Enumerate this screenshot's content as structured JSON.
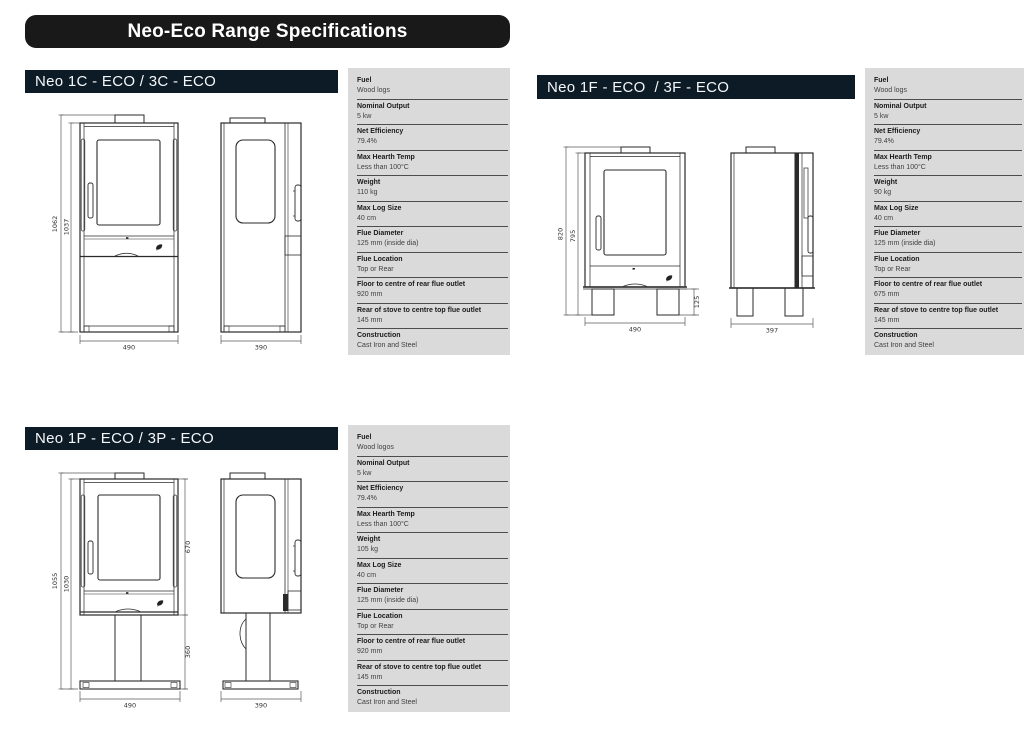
{
  "page": {
    "title": "Neo-Eco Range Specifications"
  },
  "colors": {
    "title_bar": "#191919",
    "section_header": "#0d1b27",
    "table_background": "#dadada",
    "drawing_line": "#2a2a2a"
  },
  "sections": [
    {
      "id": "neo-1c",
      "title": "Neo 1C - ECO / 3C - ECO",
      "dims": {
        "overall_height": "1062",
        "body_height": "1037",
        "front_width": "490",
        "side_depth": "390"
      },
      "specs": [
        {
          "label": "Fuel",
          "value": "Wood logs"
        },
        {
          "label": "Nominal Output",
          "value": "5 kw"
        },
        {
          "label": "Net Efficiency",
          "value": "79.4%"
        },
        {
          "label": "Max Hearth Temp",
          "value": "Less than 100°C"
        },
        {
          "label": "Weight",
          "value": "110 kg"
        },
        {
          "label": "Max Log Size",
          "value": "40 cm"
        },
        {
          "label": "Flue Diameter",
          "value": "125 mm (inside dia)"
        },
        {
          "label": "Flue Location",
          "value": "Top or Rear"
        },
        {
          "label": "Floor to centre of rear flue outlet",
          "value": "920 mm"
        },
        {
          "label": "Rear of stove to centre top flue outlet",
          "value": "145 mm"
        },
        {
          "label": "Construction",
          "value": "Cast Iron and Steel"
        }
      ]
    },
    {
      "id": "neo-1f",
      "title": "Neo 1F - ECO  / 3F - ECO",
      "dims": {
        "overall_height": "820",
        "body_height": "795",
        "front_width": "490",
        "side_depth": "397",
        "leg_height": "125"
      },
      "specs": [
        {
          "label": "Fuel",
          "value": "Wood logs"
        },
        {
          "label": "Nominal Output",
          "value": "5 kw"
        },
        {
          "label": "Net Efficiency",
          "value": "79.4%"
        },
        {
          "label": "Max Hearth Temp",
          "value": "Less than 100°C"
        },
        {
          "label": "Weight",
          "value": "90 kg"
        },
        {
          "label": "Max Log Size",
          "value": "40 cm"
        },
        {
          "label": "Flue Diameter",
          "value": "125 mm (inside dia)"
        },
        {
          "label": "Flue Location",
          "value": "Top or Rear"
        },
        {
          "label": "Floor to centre of rear flue outlet",
          "value": "675 mm"
        },
        {
          "label": "Rear of stove to centre top flue outlet",
          "value": "145 mm"
        },
        {
          "label": "Construction",
          "value": "Cast Iron and Steel"
        }
      ]
    },
    {
      "id": "neo-1p",
      "title": "Neo 1P - ECO / 3P - ECO",
      "dims": {
        "overall_height": "1055",
        "body_height": "1030",
        "front_width": "490",
        "side_depth": "390",
        "firebox_height": "670",
        "pedestal_height": "360"
      },
      "specs": [
        {
          "label": "Fuel",
          "value": "Wood logos"
        },
        {
          "label": "Nominal Output",
          "value": "5 kw"
        },
        {
          "label": "Net Efficiency",
          "value": "79.4%"
        },
        {
          "label": "Max Hearth Temp",
          "value": "Less than 100°C"
        },
        {
          "label": "Weight",
          "value": "105 kg"
        },
        {
          "label": "Max Log Size",
          "value": "40 cm"
        },
        {
          "label": "Flue Diameter",
          "value": "125 mm (inside dia)"
        },
        {
          "label": "Flue Location",
          "value": "Top or Rear"
        },
        {
          "label": "Floor to centre of rear flue outlet",
          "value": "920 mm"
        },
        {
          "label": "Rear of stove to centre top flue outlet",
          "value": "145 mm"
        },
        {
          "label": "Construction",
          "value": "Cast Iron and Steel"
        }
      ]
    }
  ]
}
